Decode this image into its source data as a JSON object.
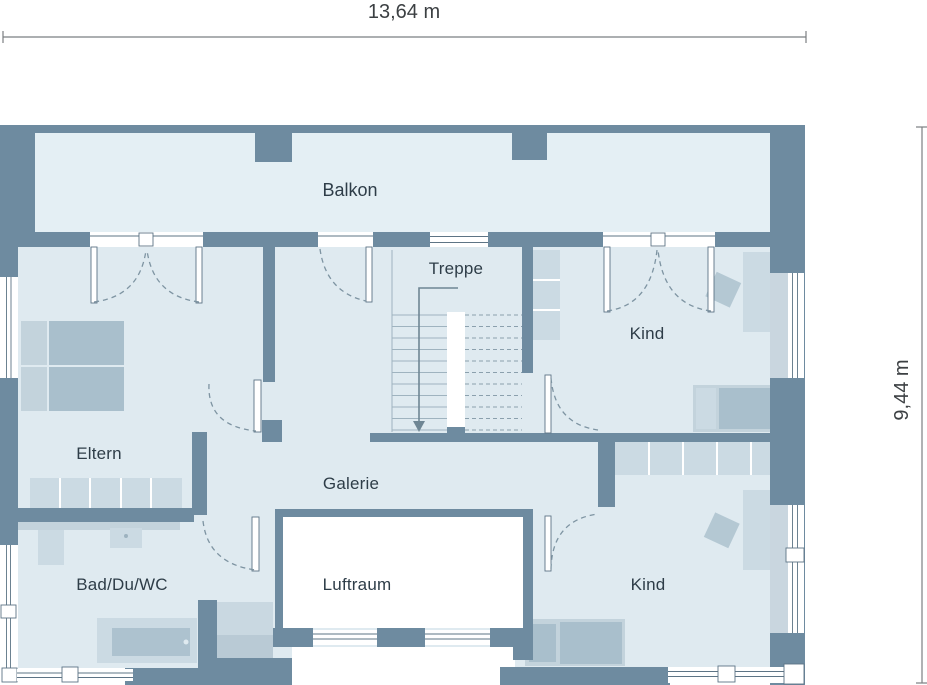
{
  "title": "Obergeschoss Grundriss",
  "dimensions": {
    "width_label": "13,64 m",
    "height_label": "9,44 m"
  },
  "rooms": {
    "balkon": "Balkon",
    "treppe": "Treppe",
    "kind_top": "Kind",
    "eltern": "Eltern",
    "galerie": "Galerie",
    "luftraum": "Luftraum",
    "bad": "Bad/Du/WC",
    "kind_bottom": "Kind"
  },
  "colors": {
    "wall": "#6e8ba0",
    "room_fill": "#dfeaf0",
    "balcony_fill": "#e4eff4",
    "furniture_light": "#cbdae3",
    "furniture_medium": "#a9bfcc",
    "void_white": "#ffffff",
    "label_text": "#2e3d48",
    "dimension_text": "#3c4043"
  }
}
